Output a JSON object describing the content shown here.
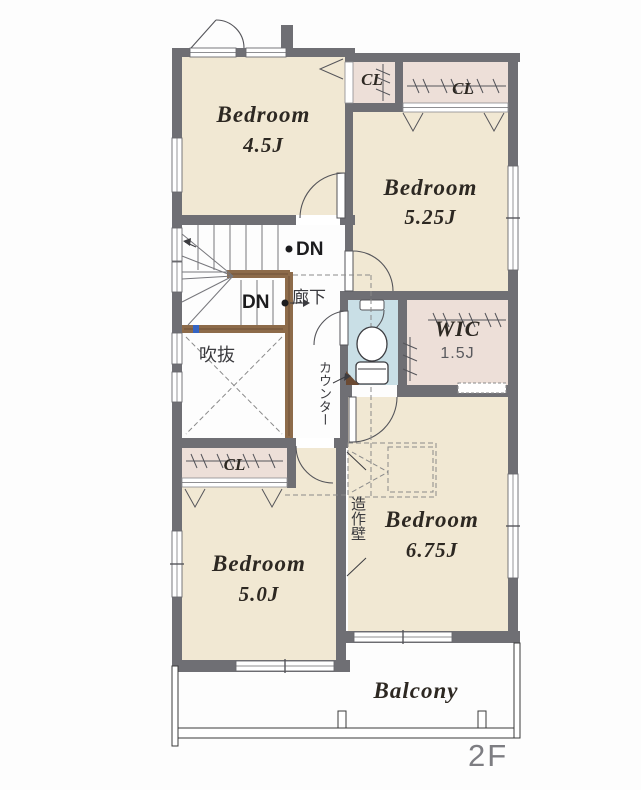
{
  "floor_label": "2F",
  "rooms": {
    "bedroom_tl": {
      "name": "Bedroom",
      "size": "4.5J"
    },
    "bedroom_tr": {
      "name": "Bedroom",
      "size": "5.25J"
    },
    "bedroom_br": {
      "name": "Bedroom",
      "size": "6.75J"
    },
    "bedroom_bl": {
      "name": "Bedroom",
      "size": "5.0J"
    },
    "wic": {
      "name": "WIC",
      "size": "1.5J"
    },
    "balcony": {
      "name": "Balcony"
    },
    "hallway": {
      "name": "廊下"
    },
    "void": {
      "name": "吹抜"
    }
  },
  "closets": {
    "top_small": "CL",
    "top_wide": "CL",
    "bottom": "CL"
  },
  "stairs": {
    "down_top": "DN",
    "down_mid": "DN"
  },
  "annotations": {
    "counter": "カウンター",
    "feature_wall": "造作壁"
  },
  "colors": {
    "wall": "#6f6f74",
    "floor_beige": "#f1e8d3",
    "floor_pink": "#eddfd8",
    "floor_toilet": "#c9dfe6",
    "wood": "#8d6b4a",
    "accent_blue": "#3565c4"
  }
}
